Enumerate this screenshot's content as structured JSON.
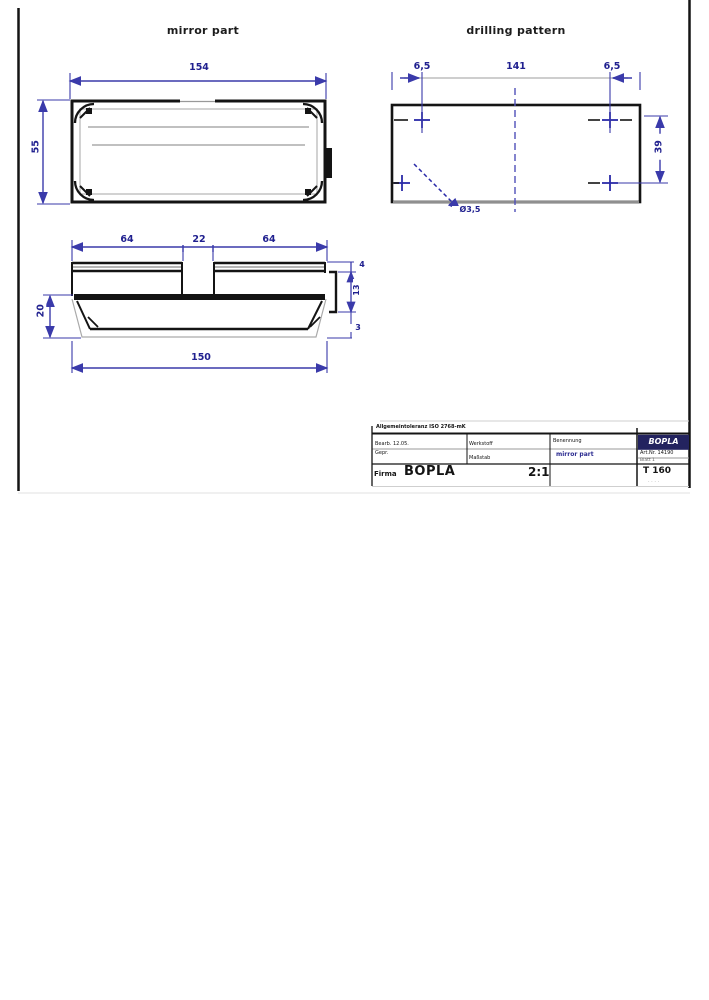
{
  "titles": {
    "left": "mirror part",
    "right": "drilling pattern"
  },
  "colors": {
    "dimension_blue": "#3a3aaa",
    "label_navy": "#20208f",
    "line_black": "#141414",
    "line_gray": "#9a9a9a",
    "logo_navy": "#23235f"
  },
  "top_view": {
    "width": "154",
    "height": "55"
  },
  "front_view": {
    "segment_left": "64",
    "segment_center": "22",
    "segment_right": "64",
    "overall_length": "150",
    "body_height": "20",
    "right_top": "4",
    "right_middle": "13",
    "right_bottom": "3"
  },
  "drilling_pattern": {
    "edge_offset_left": "6,5",
    "hole_spacing": "141",
    "edge_offset_right": "6,5",
    "hole_spacing_vertical": "39",
    "hole_callout": "Ø3,5"
  },
  "title_block": {
    "tolerance_note": "Allgemeintoleranz ISO 2768-mK",
    "drawn_label": "Bearb. 12.05.",
    "checked_label": "Gepr.",
    "material_label": "Werkstoff",
    "scale_label": "Maßstab",
    "scale_value": "2:1",
    "name_label": "Benennung",
    "part_name": "mirror part",
    "company_label": "Firma",
    "company_name": "BOPLA",
    "logo_text": "BOPLA",
    "article_no": "Art.Nr. 14190",
    "sheet": "Blatt 1",
    "part_code": "T 160",
    "revision_dots": "· · · ·"
  }
}
